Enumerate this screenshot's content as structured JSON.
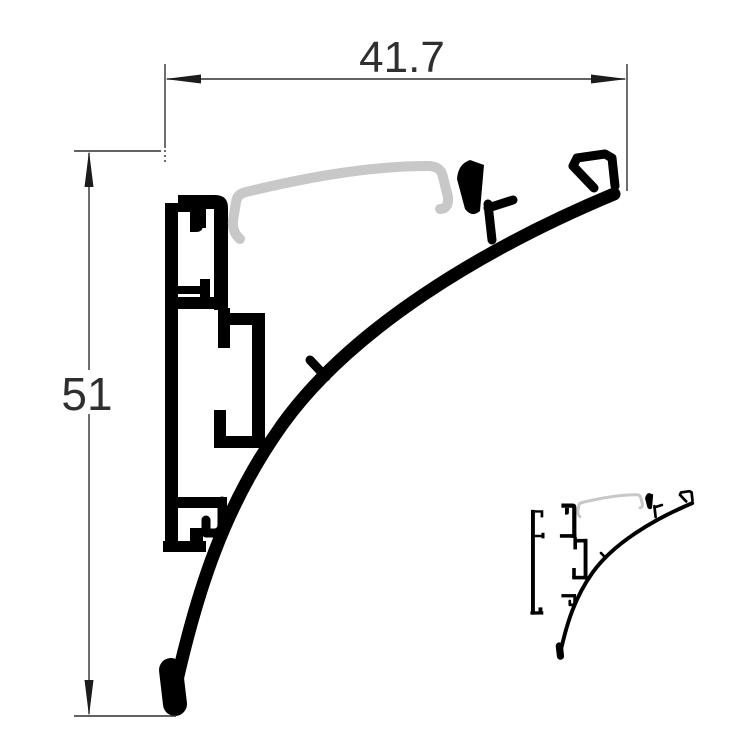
{
  "drawing": {
    "dimensions": {
      "width": {
        "label": "41.7"
      },
      "height": {
        "label": "51"
      }
    }
  },
  "colors": {
    "background": "#ffffff",
    "profile_ink": "#000000",
    "diffuser_gray": "#c8c8c8",
    "dimension_ink": "#2f2f2f"
  }
}
